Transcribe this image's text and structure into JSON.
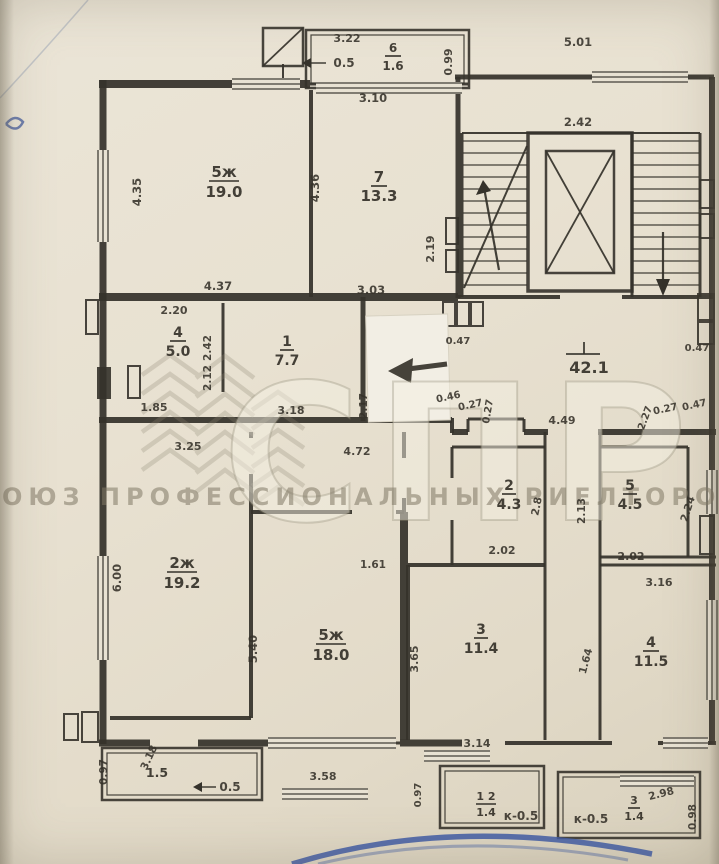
{
  "watermark": {
    "letters": "СПР",
    "caption": "СОЮЗ ПРОФЕССИОНАЛЬНЫХ РИЕЛТОРОВ"
  },
  "plan": {
    "rooms": [
      {
        "id": "r6",
        "number": "6",
        "area": "1.6"
      },
      {
        "id": "r5t",
        "number": "5ж",
        "area": "19.0"
      },
      {
        "id": "r7",
        "number": "7",
        "area": "13.3"
      },
      {
        "id": "r4s",
        "number": "4",
        "area": "5.0"
      },
      {
        "id": "r1",
        "number": "1",
        "area": "7.7"
      },
      {
        "id": "cor",
        "number": "",
        "area": "42.1"
      },
      {
        "id": "r2z",
        "number": "2ж",
        "area": "19.2"
      },
      {
        "id": "r5b",
        "number": "5ж",
        "area": "18.0"
      },
      {
        "id": "r2",
        "number": "2",
        "area": "4.3"
      },
      {
        "id": "r5",
        "number": "5",
        "area": "4.5"
      },
      {
        "id": "r3",
        "number": "3",
        "area": "11.4"
      },
      {
        "id": "r4b",
        "number": "4",
        "area": "11.5"
      },
      {
        "id": "bl",
        "number": "",
        "area": "1.5"
      },
      {
        "id": "bm",
        "number": "1 2",
        "area": "1.4"
      },
      {
        "id": "br",
        "number": "3",
        "area": "1.4"
      }
    ],
    "dimensions": [
      {
        "id": "d322",
        "text": "3.22"
      },
      {
        "id": "d099",
        "text": "0.99"
      },
      {
        "id": "ktop",
        "text": "0.5"
      },
      {
        "id": "d501",
        "text": "5.01"
      },
      {
        "id": "d242e",
        "text": "2.42"
      },
      {
        "id": "d435",
        "text": "4.35"
      },
      {
        "id": "d436",
        "text": "4.36"
      },
      {
        "id": "d437",
        "text": "4.37"
      },
      {
        "id": "d310",
        "text": "3.10"
      },
      {
        "id": "d219",
        "text": "2.19"
      },
      {
        "id": "d303",
        "text": "3.03"
      },
      {
        "id": "d220",
        "text": "2.20"
      },
      {
        "id": "d185",
        "text": "1.85"
      },
      {
        "id": "d242r",
        "text": "2.42"
      },
      {
        "id": "d212",
        "text": "2.12"
      },
      {
        "id": "d318a",
        "text": "3.18"
      },
      {
        "id": "d047a",
        "text": "0.47"
      },
      {
        "id": "d047c",
        "text": "0.47"
      },
      {
        "id": "d046",
        "text": "0.46"
      },
      {
        "id": "d027a",
        "text": "0.27"
      },
      {
        "id": "d027b",
        "text": "0.27"
      },
      {
        "id": "d449",
        "text": "4.49"
      },
      {
        "id": "d227",
        "text": "2.27"
      },
      {
        "id": "d027c",
        "text": "0.27"
      },
      {
        "id": "d047b",
        "text": "0.47"
      },
      {
        "id": "d217",
        "text": "2.17"
      },
      {
        "id": "d472",
        "text": "4.72"
      },
      {
        "id": "d325",
        "text": "3.25"
      },
      {
        "id": "d600",
        "text": "6.00"
      },
      {
        "id": "d161",
        "text": "1.61"
      },
      {
        "id": "d540",
        "text": "5.40"
      },
      {
        "id": "d358",
        "text": "3.58"
      },
      {
        "id": "d28",
        "text": "2.8"
      },
      {
        "id": "d213",
        "text": "2.13"
      },
      {
        "id": "d202a",
        "text": "2.02"
      },
      {
        "id": "d202b",
        "text": "2.02"
      },
      {
        "id": "d224",
        "text": "2.24"
      },
      {
        "id": "d316",
        "text": "3.16"
      },
      {
        "id": "d365",
        "text": "3.65"
      },
      {
        "id": "d164",
        "text": "1.64"
      },
      {
        "id": "d314",
        "text": "3.14"
      },
      {
        "id": "d097a",
        "text": "0.97"
      },
      {
        "id": "d318b",
        "text": "3.18"
      },
      {
        "id": "kleft",
        "text": "0.5"
      },
      {
        "id": "d097b",
        "text": "0.97"
      },
      {
        "id": "kmid",
        "text": "к-0.5"
      },
      {
        "id": "d298",
        "text": "2.98"
      },
      {
        "id": "d098",
        "text": "0.98"
      },
      {
        "id": "kright",
        "text": "к-0.5"
      }
    ]
  }
}
